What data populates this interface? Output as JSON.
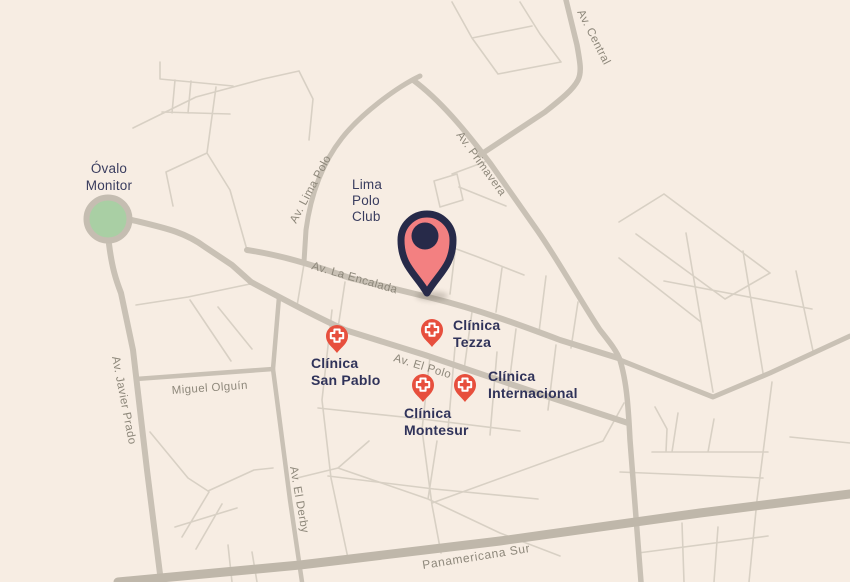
{
  "map": {
    "title": "neighborhood-map",
    "places": {
      "ovalo": {
        "line1": "Óvalo",
        "line2": "Monitor"
      },
      "polo_club": {
        "line1": "Lima",
        "line2": "Polo",
        "line3": "Club"
      }
    },
    "streets": {
      "javier_prado": "Av. Javier Prado",
      "lima_polo": "Av. Lima Polo",
      "la_encalada": "Av. La Encalada",
      "primavera": "Av. Primavera",
      "central": "Av. Central",
      "el_polo": "Av. El Polo",
      "miguel_olguin": "Miguel Olguín",
      "el_derby": "Av. El Derby",
      "panamericana": "Panamericana Sur"
    },
    "clinics": [
      {
        "id": "tezza",
        "line1": "Clínica",
        "line2": "Tezza"
      },
      {
        "id": "san_pablo",
        "line1": "Clínica",
        "line2": "San Pablo"
      },
      {
        "id": "montesur",
        "line1": "Clínica",
        "line2": "Montesur"
      },
      {
        "id": "internacional",
        "line1": "Clínica",
        "line2": "Internacional"
      }
    ]
  },
  "colors": {
    "background": "#f7ede3",
    "road_minor": "#d8d0c4",
    "road_major": "#c9c1b5",
    "highway": "#bfb7aa",
    "roundabout_green": "#a9cfa4",
    "navy_text": "#30335a",
    "street_text": "#8e887b",
    "clinic_marker_red": "#e74f3d",
    "cross_white": "#ffffff",
    "pin_fill": "#f38081",
    "pin_outline": "#272a49"
  }
}
